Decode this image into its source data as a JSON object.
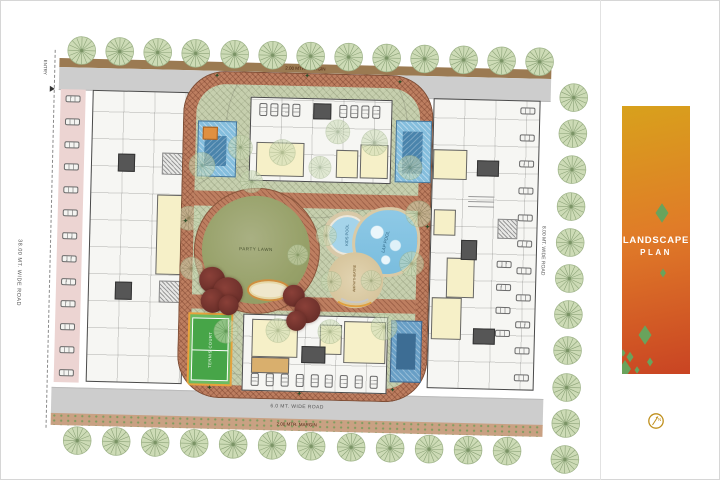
{
  "banner": {
    "title_line1": "LANDSCAPE",
    "title_line2": "PLAN",
    "background_top": "#D8A11C",
    "background_mid": "#E07B28",
    "background_bottom": "#C94423",
    "diamond_color": "#69A35C",
    "text_color": "#FFFFFF"
  },
  "compass": {
    "label": "N",
    "color": "#BF8F1C"
  },
  "plan": {
    "entry_label": "ENTRY",
    "roads": {
      "left": "38.00 MT. WIDE ROAD",
      "right": "8.00 MT. WIDE ROAD",
      "top": "6.0 MT. WIDE ROAD",
      "bottom": "6.0 MT. WIDE ROAD",
      "top_margin": "2.00 MTR. MARGIN",
      "bottom_margin": "2.00 MTR. MARGIN"
    },
    "amenities": {
      "party_lawn": "PARTY LAWN",
      "kids_pool": "KIDS POOL",
      "lap_pool": "LAP POOL",
      "amphitheatre": "AMPHITHEATRE",
      "tennis_court": "TENNIS COURT"
    },
    "icons": {
      "star_mark": "✦"
    },
    "colors": {
      "road_gray": "#CDCDCD",
      "parking_strip_pink": "#ECD4D2",
      "ring_road_terracotta": "#BD7E60",
      "campus_green": "#C6CFAE",
      "lawn_olive": "#97A169",
      "pool_blue": "#8EC9E6",
      "court_blue": "#699FC6",
      "court_green": "#47A548",
      "room_yellow": "#F6F0C8",
      "shrub_maroon": "#7D3A33",
      "tree_green": "#CDDBB6"
    }
  }
}
